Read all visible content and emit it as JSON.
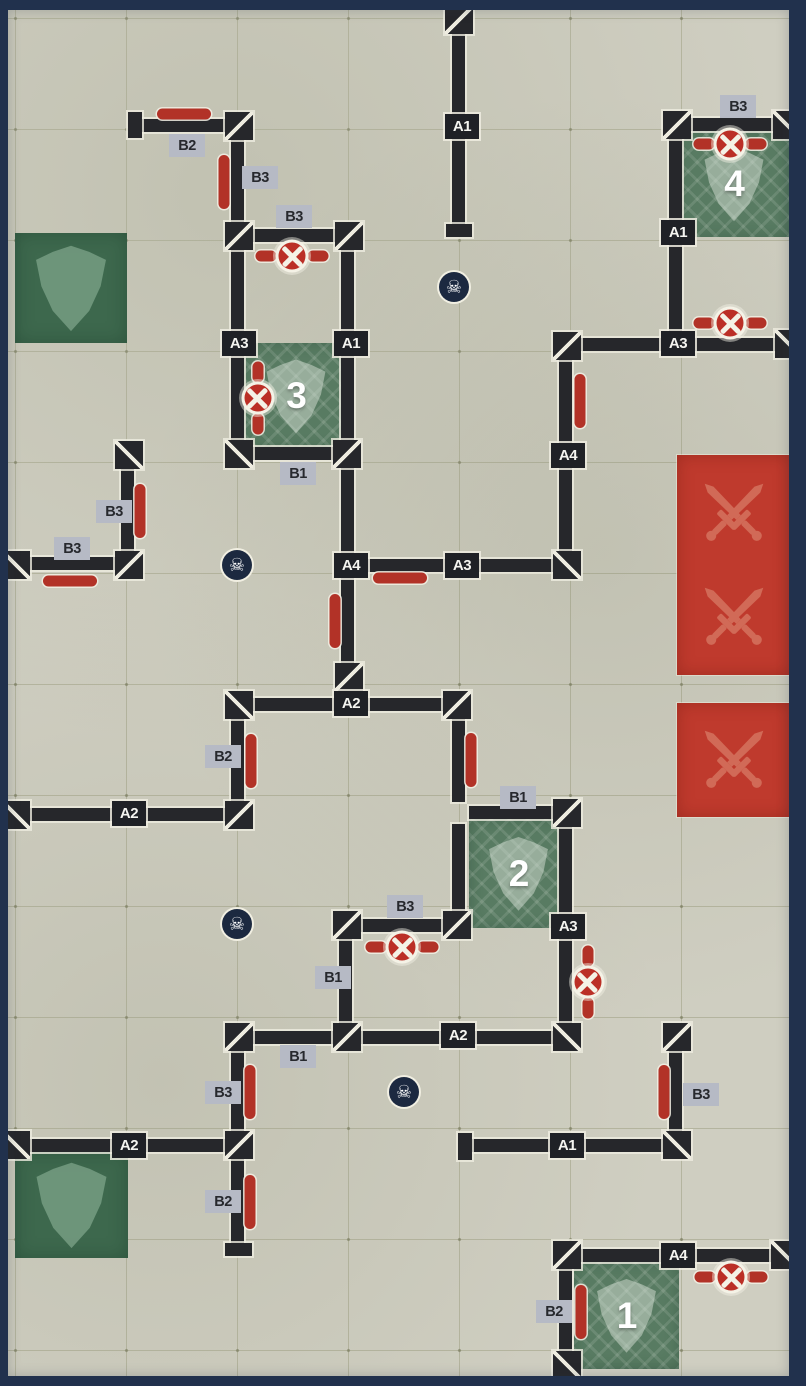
{
  "board": {
    "title": "killzone-map-board",
    "size": {
      "w": 806,
      "h": 1386
    },
    "grid": {
      "cell": 111,
      "origin_x": 15,
      "origin_y": 18
    },
    "colors": {
      "background": "#cfcec1",
      "border": "#21314d",
      "grid": "#8a8a66",
      "wall": "#26272b",
      "wall_outline": "#eeece0",
      "chip_dark_bg": "#1f2126",
      "chip_dark_text": "#f4f4f0",
      "chip_gray_bg": "#b6bac5",
      "chip_gray_text": "#27292e",
      "barricade_red": "#b23227",
      "engage_zone_red": "#bf3a2d",
      "sword": "#d4705c",
      "objective_green": "#587b62",
      "defend_green": "#3d684d",
      "skull_bg": "#1c2940"
    },
    "icons": {
      "skull": "skull-icon",
      "skull_glyph": "☠",
      "valve": "valve-wheel-icon",
      "barricade": "barricade-marker",
      "shield": "shield-icon",
      "swords": "crossed-swords-icon"
    },
    "walls": [
      [
        452,
        30,
        13,
        196
      ],
      [
        140,
        119,
        87,
        13
      ],
      [
        231,
        138,
        13,
        86
      ],
      [
        251,
        229,
        86,
        13
      ],
      [
        231,
        248,
        13,
        194
      ],
      [
        341,
        248,
        13,
        194
      ],
      [
        251,
        447,
        84,
        13
      ],
      [
        341,
        466,
        13,
        199
      ],
      [
        353,
        559,
        202,
        13
      ],
      [
        559,
        358,
        13,
        195
      ],
      [
        579,
        338,
        198,
        13
      ],
      [
        669,
        135,
        13,
        205
      ],
      [
        689,
        118,
        86,
        13
      ],
      [
        121,
        467,
        13,
        86
      ],
      [
        26,
        557,
        93,
        13
      ],
      [
        251,
        698,
        194,
        13
      ],
      [
        231,
        717,
        13,
        86
      ],
      [
        28,
        808,
        199,
        13
      ],
      [
        452,
        717,
        13,
        85
      ],
      [
        469,
        806,
        86,
        13
      ],
      [
        452,
        824,
        13,
        89
      ],
      [
        559,
        825,
        13,
        200
      ],
      [
        359,
        919,
        86,
        13
      ],
      [
        339,
        937,
        13,
        88
      ],
      [
        251,
        1031,
        84,
        13
      ],
      [
        359,
        1031,
        196,
        13
      ],
      [
        231,
        1049,
        13,
        84
      ],
      [
        28,
        1139,
        199,
        13
      ],
      [
        231,
        1157,
        13,
        88
      ],
      [
        669,
        1049,
        13,
        84
      ],
      [
        471,
        1139,
        194,
        13
      ],
      [
        579,
        1249,
        194,
        13
      ],
      [
        559,
        1267,
        13,
        86
      ]
    ],
    "caps": [
      [
        446,
        224,
        26,
        13
      ],
      [
        128,
        112,
        14,
        26
      ],
      [
        225,
        1243,
        27,
        13
      ],
      [
        458,
        1133,
        14,
        27
      ]
    ],
    "corners": [
      {
        "x": 445,
        "y": 6,
        "d": "/"
      },
      {
        "x": 225,
        "y": 112,
        "d": "/"
      },
      {
        "x": 225,
        "y": 222,
        "d": "/"
      },
      {
        "x": 335,
        "y": 222,
        "d": "/"
      },
      {
        "x": 115,
        "y": 441,
        "d": "\\"
      },
      {
        "x": 115,
        "y": 551,
        "d": "/"
      },
      {
        "x": 2,
        "y": 551,
        "d": "\\"
      },
      {
        "x": 225,
        "y": 440,
        "d": "\\"
      },
      {
        "x": 333,
        "y": 440,
        "d": "/"
      },
      {
        "x": 335,
        "y": 663,
        "d": "/"
      },
      {
        "x": 225,
        "y": 691,
        "d": "\\"
      },
      {
        "x": 443,
        "y": 691,
        "d": "/"
      },
      {
        "x": 2,
        "y": 801,
        "d": "\\"
      },
      {
        "x": 225,
        "y": 801,
        "d": "/"
      },
      {
        "x": 553,
        "y": 551,
        "d": "\\"
      },
      {
        "x": 553,
        "y": 332,
        "d": "/"
      },
      {
        "x": 663,
        "y": 111,
        "d": "/"
      },
      {
        "x": 773,
        "y": 111,
        "d": "\\"
      },
      {
        "x": 775,
        "y": 330,
        "d": "\\"
      },
      {
        "x": 553,
        "y": 799,
        "d": "/"
      },
      {
        "x": 443,
        "y": 911,
        "d": "/"
      },
      {
        "x": 333,
        "y": 911,
        "d": "/"
      },
      {
        "x": 553,
        "y": 1023,
        "d": "\\"
      },
      {
        "x": 333,
        "y": 1023,
        "d": "/"
      },
      {
        "x": 225,
        "y": 1023,
        "d": "/"
      },
      {
        "x": 663,
        "y": 1023,
        "d": "/"
      },
      {
        "x": 225,
        "y": 1131,
        "d": "/"
      },
      {
        "x": 2,
        "y": 1131,
        "d": "\\"
      },
      {
        "x": 663,
        "y": 1131,
        "d": "\\"
      },
      {
        "x": 553,
        "y": 1241,
        "d": "/"
      },
      {
        "x": 771,
        "y": 1241,
        "d": "\\"
      },
      {
        "x": 553,
        "y": 1351,
        "d": "\\"
      }
    ],
    "wall_labels": [
      {
        "text": "A1",
        "x": 445,
        "y": 114
      },
      {
        "text": "A3",
        "x": 222,
        "y": 331
      },
      {
        "text": "A1",
        "x": 334,
        "y": 331
      },
      {
        "text": "A4",
        "x": 334,
        "y": 553
      },
      {
        "text": "A3",
        "x": 445,
        "y": 553
      },
      {
        "text": "A4",
        "x": 551,
        "y": 443
      },
      {
        "text": "A3",
        "x": 661,
        "y": 331
      },
      {
        "text": "A1",
        "x": 661,
        "y": 220
      },
      {
        "text": "A2",
        "x": 334,
        "y": 691
      },
      {
        "text": "A2",
        "x": 112,
        "y": 801
      },
      {
        "text": "A3",
        "x": 551,
        "y": 914
      },
      {
        "text": "A2",
        "x": 441,
        "y": 1023
      },
      {
        "text": "A2",
        "x": 112,
        "y": 1133
      },
      {
        "text": "A1",
        "x": 550,
        "y": 1133
      },
      {
        "text": "A4",
        "x": 661,
        "y": 1243
      }
    ],
    "side_labels": [
      {
        "text": "B2",
        "x": 169,
        "y": 134
      },
      {
        "text": "B3",
        "x": 242,
        "y": 166
      },
      {
        "text": "B3",
        "x": 276,
        "y": 205
      },
      {
        "text": "B3",
        "x": 720,
        "y": 95
      },
      {
        "text": "B3",
        "x": 96,
        "y": 500
      },
      {
        "text": "B3",
        "x": 54,
        "y": 537
      },
      {
        "text": "B1",
        "x": 280,
        "y": 462
      },
      {
        "text": "B2",
        "x": 205,
        "y": 745
      },
      {
        "text": "B1",
        "x": 500,
        "y": 786
      },
      {
        "text": "B3",
        "x": 387,
        "y": 895
      },
      {
        "text": "B1",
        "x": 315,
        "y": 966
      },
      {
        "text": "B1",
        "x": 280,
        "y": 1045
      },
      {
        "text": "B3",
        "x": 205,
        "y": 1081
      },
      {
        "text": "B2",
        "x": 205,
        "y": 1190
      },
      {
        "text": "B3",
        "x": 683,
        "y": 1083
      },
      {
        "text": "B2",
        "x": 536,
        "y": 1300
      }
    ],
    "barricades": [
      {
        "x": 184,
        "y": 114,
        "o": "h"
      },
      {
        "x": 224,
        "y": 182,
        "o": "v"
      },
      {
        "x": 140,
        "y": 511,
        "o": "v"
      },
      {
        "x": 70,
        "y": 581,
        "o": "h"
      },
      {
        "x": 580,
        "y": 401,
        "o": "v"
      },
      {
        "x": 400,
        "y": 578,
        "o": "h"
      },
      {
        "x": 335,
        "y": 621,
        "o": "v"
      },
      {
        "x": 251,
        "y": 761,
        "o": "v"
      },
      {
        "x": 471,
        "y": 760,
        "o": "v"
      },
      {
        "x": 250,
        "y": 1092,
        "o": "v"
      },
      {
        "x": 250,
        "y": 1202,
        "o": "v"
      },
      {
        "x": 664,
        "y": 1092,
        "o": "v"
      },
      {
        "x": 581,
        "y": 1312,
        "o": "v"
      }
    ],
    "valves": [
      {
        "x": 292,
        "y": 256,
        "o": "h"
      },
      {
        "x": 730,
        "y": 144,
        "o": "h"
      },
      {
        "x": 730,
        "y": 323,
        "o": "h"
      },
      {
        "x": 258,
        "y": 398,
        "o": "v"
      },
      {
        "x": 402,
        "y": 947,
        "o": "h"
      },
      {
        "x": 588,
        "y": 982,
        "o": "v"
      },
      {
        "x": 731,
        "y": 1277,
        "o": "h"
      }
    ],
    "skulls": [
      {
        "x": 454,
        "y": 287
      },
      {
        "x": 237,
        "y": 565
      },
      {
        "x": 237,
        "y": 924
      },
      {
        "x": 404,
        "y": 1092
      }
    ],
    "objectives": [
      {
        "label": "4",
        "x": 678,
        "y": 131,
        "w": 112,
        "h": 106
      },
      {
        "label": "3",
        "x": 238,
        "y": 343,
        "w": 116,
        "h": 106
      },
      {
        "label": "2",
        "x": 469,
        "y": 819,
        "w": 99,
        "h": 109
      },
      {
        "label": "1",
        "x": 574,
        "y": 1262,
        "w": 105,
        "h": 107
      }
    ],
    "shield_zones": [
      {
        "x": 15,
        "y": 233,
        "w": 112,
        "h": 110
      },
      {
        "x": 15,
        "y": 1152,
        "w": 113,
        "h": 106
      }
    ],
    "engage_zones": [
      {
        "x": 677,
        "y": 455,
        "w": 113,
        "h": 220,
        "icons": 2
      },
      {
        "x": 677,
        "y": 703,
        "w": 113,
        "h": 114,
        "icons": 1
      }
    ]
  }
}
